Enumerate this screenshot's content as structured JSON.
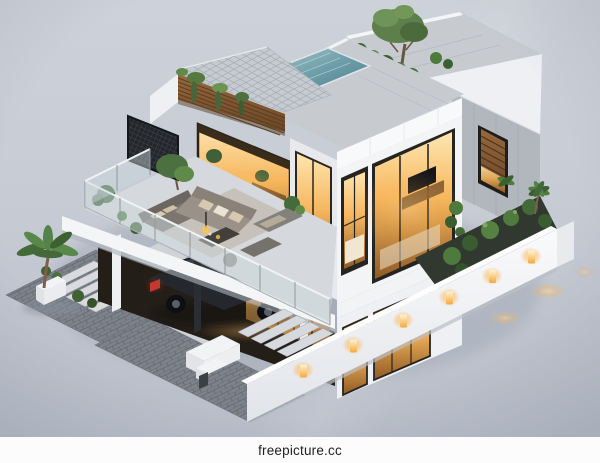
{
  "meta": {
    "type": "3d-architectural-render",
    "subject": "Modern two-story villa with rooftop pool, solar-tile roof, furnished terrace, carport with car, and lit perimeter wall — aerial isometric view at dusk"
  },
  "watermark": {
    "text": "freepicture.cc"
  },
  "palette": {
    "background_top": "#cdd2da",
    "background_bottom": "#b6bcc7",
    "wall_white": "#f3f4f6",
    "wall_white_shaded": "#e7e9ed",
    "wall_gray": "#b2b7be",
    "roof_deck": "#c7cbd0",
    "pool_water": "#6f9fab",
    "wood_slats": "#8a6136",
    "warm_light": "#f5b75c",
    "foliage": "#4f7a3d",
    "foliage_dark": "#3a5c31",
    "glass_railing": "#ccd7dc",
    "car_body": "#24272c",
    "car_taillight": "#c23a2e",
    "paver": "#7e838b",
    "step_tread": "#d6d9dd",
    "garden_soil": "#31382f",
    "footer_bg": "#fcfcfd",
    "footer_text": "#1f1f1f"
  },
  "scene": {
    "elements": [
      "rooftop-pool",
      "solar-tile-roof",
      "rooftop-garden",
      "rooftop-tree",
      "wood-slat-facade",
      "terrace-lounge",
      "glass-railing",
      "trellis-screen",
      "tower-windows",
      "slit-window",
      "carport",
      "car",
      "entry-steps",
      "perimeter-wall",
      "wall-lights",
      "palm-trees",
      "driveway-pavers",
      "planter-boxes"
    ]
  }
}
